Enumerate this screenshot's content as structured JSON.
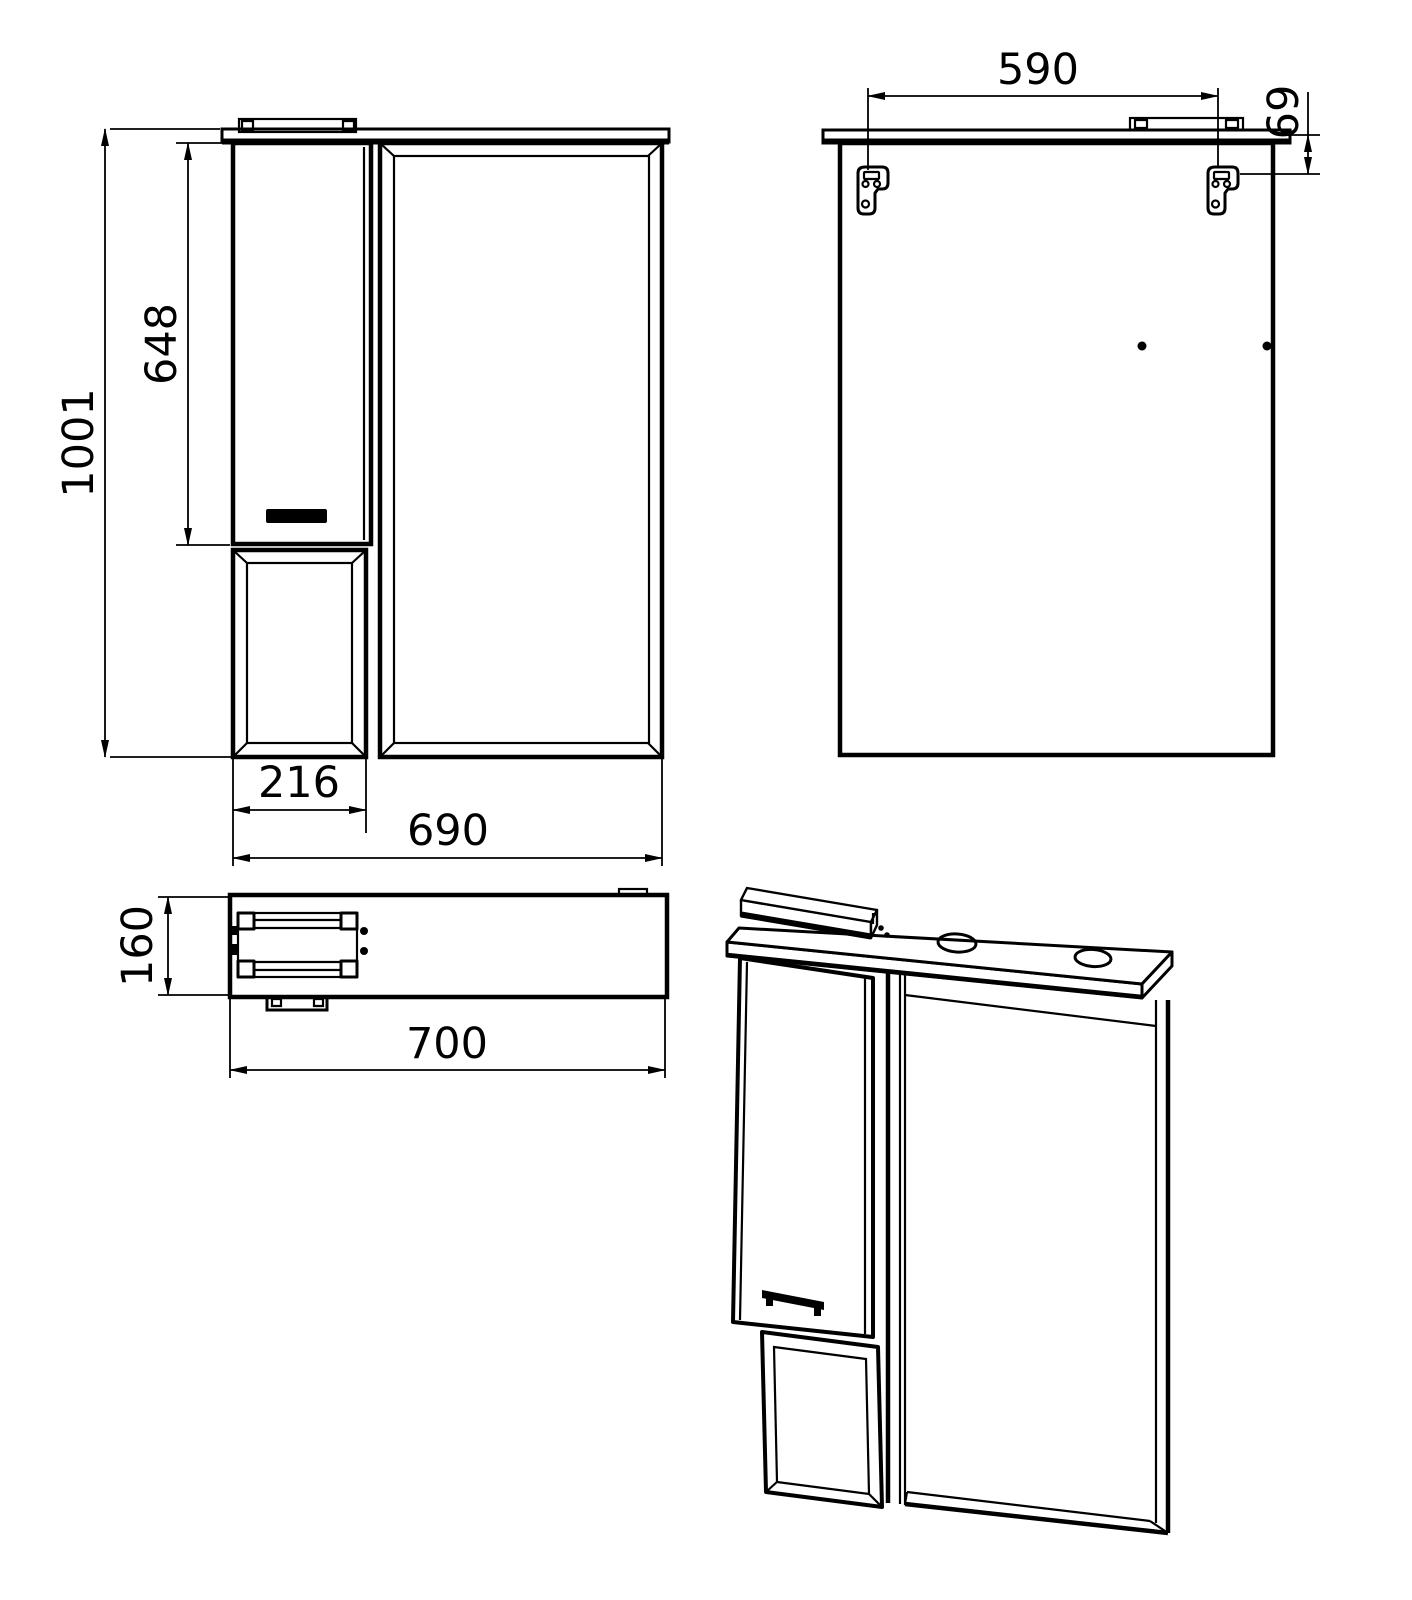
{
  "page": {
    "background_color": "#ffffff",
    "line_color": "#000000"
  },
  "views": {
    "front": {
      "dims": {
        "total_height": "1001",
        "door_height": "648",
        "cabinet_width": "216",
        "total_width": "690"
      }
    },
    "back": {
      "dims": {
        "hanger_spacing": "590",
        "hanger_top_offset": "69"
      }
    },
    "top": {
      "dims": {
        "depth": "160",
        "overall_width": "700"
      }
    }
  }
}
